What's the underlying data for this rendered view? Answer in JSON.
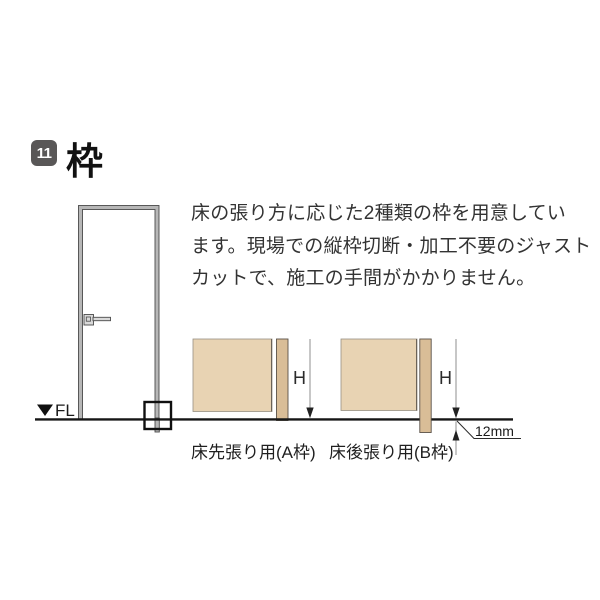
{
  "header": {
    "badge": "11",
    "title": "枠"
  },
  "intro": {
    "lines": [
      "床の張り方に応じた2種類の枠を用意してい",
      "ます。現場での縦枠切断・加工不要のジャスト",
      "カットで、施工の手間がかかりません。"
    ]
  },
  "door": {
    "fl_label": "FL"
  },
  "diagrams": {
    "a": {
      "caption": "床先張り用(A枠)",
      "h_label": "H"
    },
    "b": {
      "caption": "床後張り用(B枠)",
      "h_label": "H",
      "offset_label": "12mm"
    }
  },
  "colors": {
    "badgeBg": "#595757",
    "badgeText": "#ffffff",
    "wallFill": "#e8d3b3",
    "frameFill": "#d9bd97",
    "doorGray": "#b7b7b7",
    "lineDark": "#161616",
    "dimGray": "#8f8f8f",
    "textMain": "#333333"
  }
}
